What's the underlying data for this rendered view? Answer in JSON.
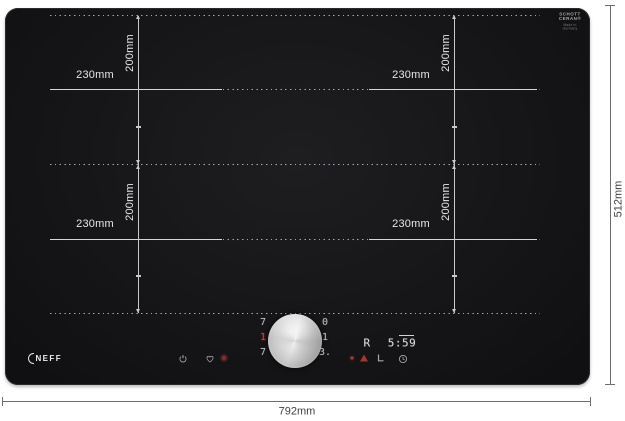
{
  "product": {
    "brand_logo": "NEFF",
    "glass_logo": {
      "line1": "SCHOTT",
      "line2": "CERAN®",
      "small_print_line1": "Made in",
      "small_print_line2": "Germany"
    }
  },
  "measurements": {
    "overall_width": "792mm",
    "overall_height": "512mm",
    "zone_width": "230mm",
    "zone_height": "200mm"
  },
  "display": {
    "left_zone_levels": {
      "top": "7",
      "middle": "1",
      "bottom": "7"
    },
    "right_zone_levels": {
      "top": "0",
      "middle": "1",
      "bottom": "3."
    },
    "heat_indicator": "R",
    "timer": "5:59",
    "icons": {
      "power": "power-icon",
      "favorite": "heart-icon",
      "active": "red-indicator-dot",
      "warning": "warning-triangle-icon",
      "lock": "key-lock-icon",
      "clock": "clock-icon"
    }
  },
  "colors": {
    "hob_surface": "#151517",
    "markings": "#d8d8d8",
    "display_red": "#b03a2e",
    "outer_dimension_text": "#3f3f3f"
  }
}
